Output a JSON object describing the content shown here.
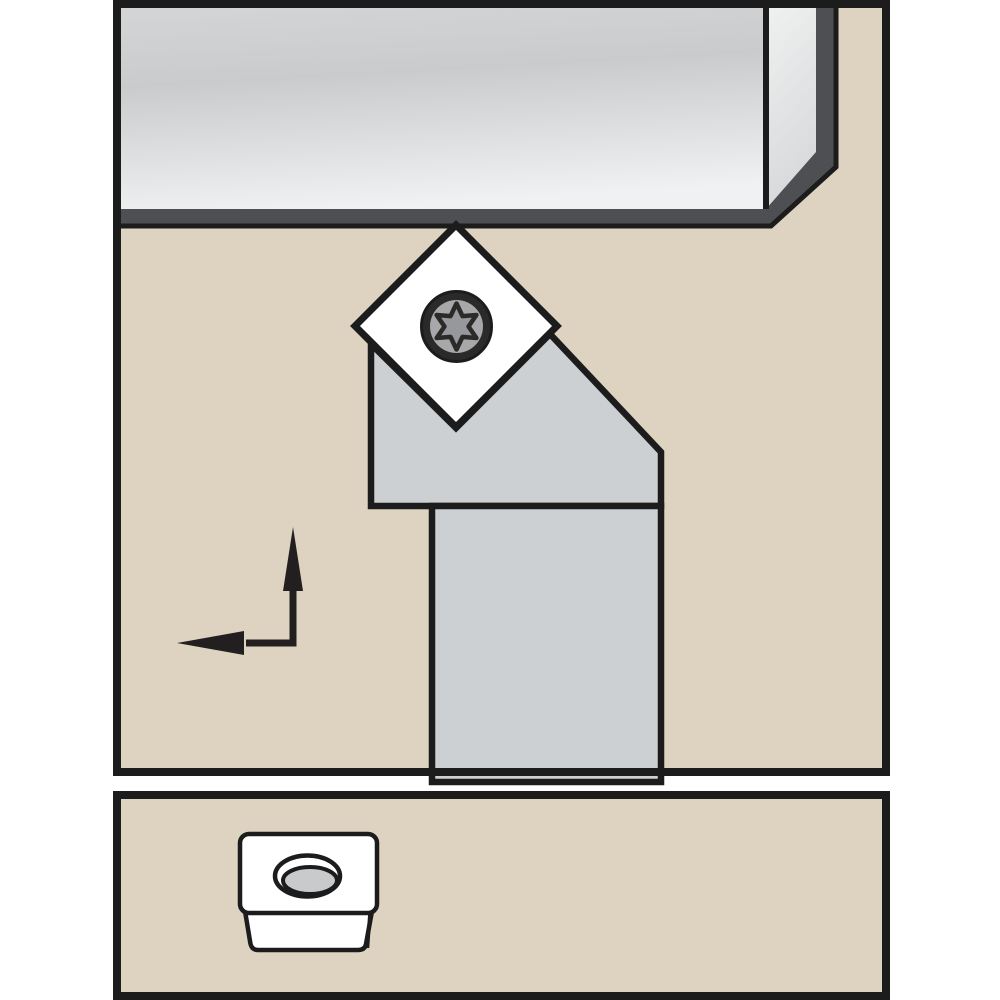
{
  "illustration": {
    "title": "turning-toolholder-side-view-with-insert-detail",
    "main_panel": {
      "parts": [
        "workpiece-bar",
        "diamond-insert",
        "torx-clamp-screw",
        "toolholder-head",
        "toolholder-shank",
        "feed-direction-arrow"
      ]
    },
    "detail_panel": {
      "parts": [
        "indexable-insert-top-face",
        "indexable-insert-front-face",
        "countersunk-screw-hole"
      ]
    }
  },
  "colors": {
    "page_bg": "#ffffff",
    "panel_bg": "#ddd3c0",
    "frame": "#1c1c1c",
    "outline": "#1c1c1c",
    "workpiece_rim": "#4e4f52",
    "workpiece_face_top": "#d5d6d8",
    "workpiece_face_mid": "#c9cbcd",
    "workpiece_face_bottom": "#f0f1f2",
    "workpiece_end_top": "#f1f2f2",
    "workpiece_end_bottom": "#d7d9da",
    "holder_body": "#cdd0d3",
    "insert_white": "#ffffff",
    "screw_ring": "#2b2a29",
    "screw_face": "#a7a8aa",
    "screw_star": "#97989b",
    "hole_bore": "#c9cacb",
    "arrow": "#231f20"
  }
}
